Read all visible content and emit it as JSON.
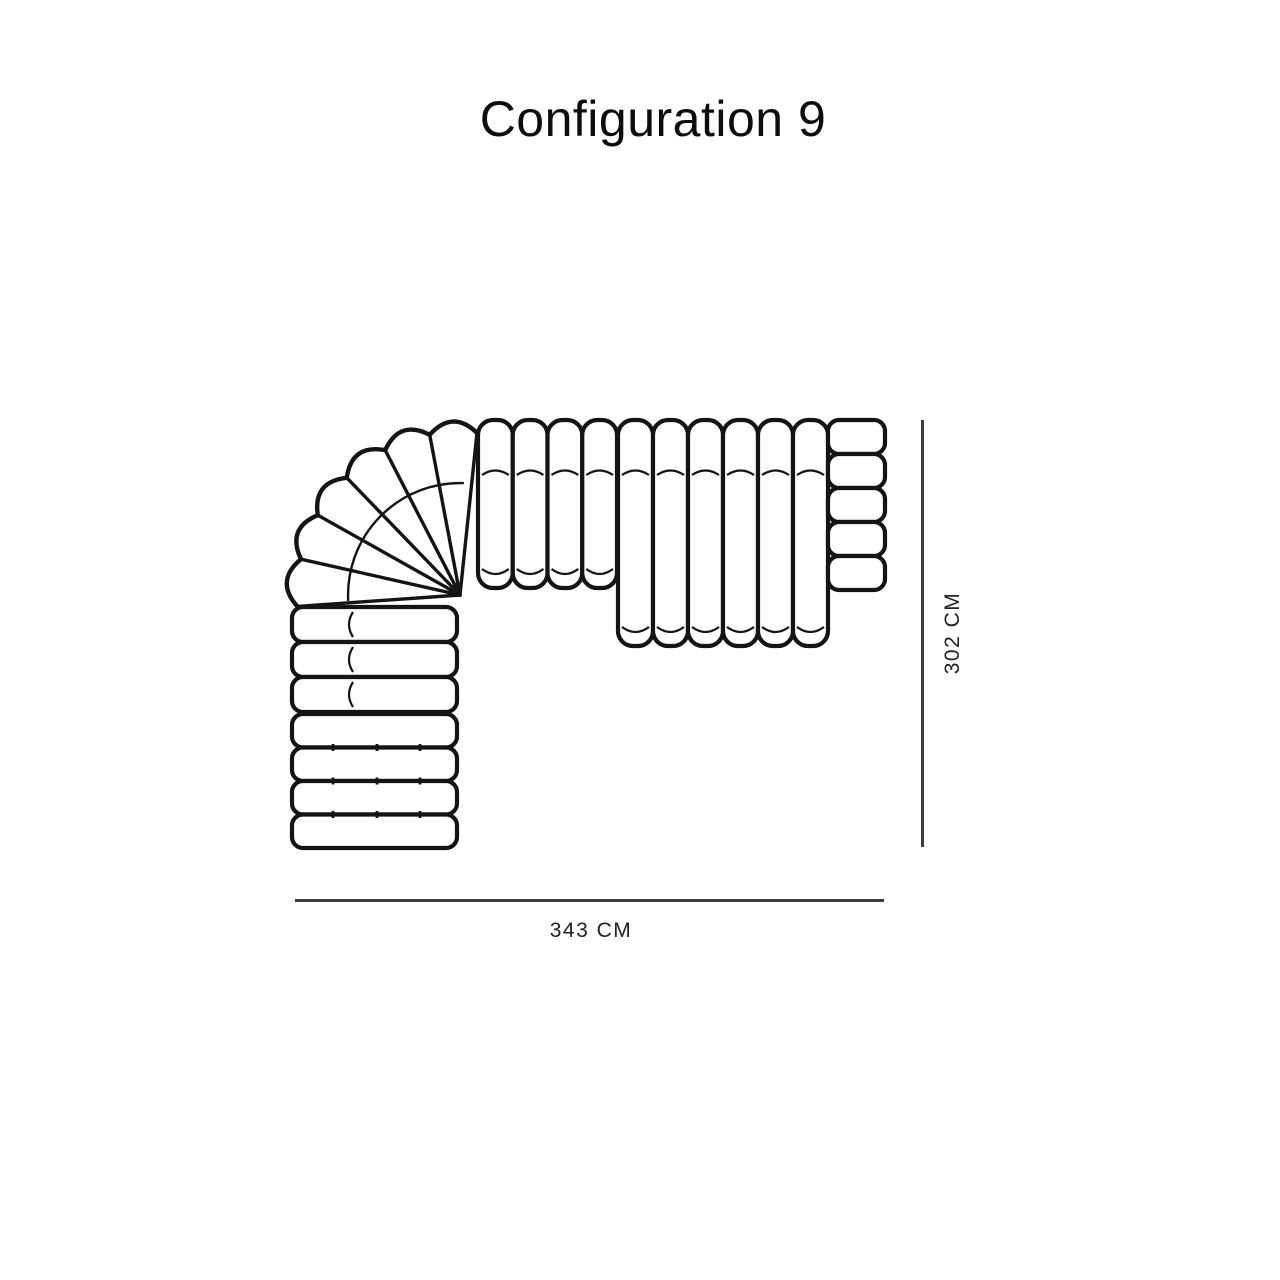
{
  "page": {
    "title": "Configuration 9",
    "background_color": "#ffffff"
  },
  "diagram": {
    "type": "modular-sofa-configuration-top-view",
    "line_color": "#141414",
    "dimension": {
      "width_label": "343 CM",
      "height_label": "302 CM",
      "line_color": "#3f3c3c"
    },
    "modules": [
      {
        "name": "corner-curve-module",
        "wedge_channels": 6
      },
      {
        "name": "top-straight-module-short",
        "channels": 4
      },
      {
        "name": "top-straight-module-long",
        "channels": 6
      },
      {
        "name": "right-armrest-module",
        "segments": 5
      },
      {
        "name": "left-straight-module-upper",
        "channels": 3
      },
      {
        "name": "left-straight-module-lower",
        "channels": 4
      }
    ]
  }
}
